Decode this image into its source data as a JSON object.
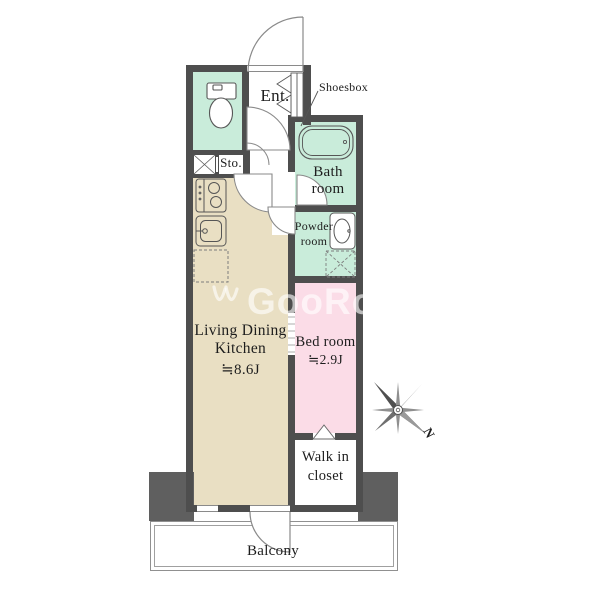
{
  "colors": {
    "wall": "#4e4e4e",
    "pillar": "#5f5f5f",
    "mint": "#c9ecda",
    "beige": "#e9dfc3",
    "pink": "#fbdce7"
  },
  "watermark": {
    "text": "GooRooM",
    "logo_icon": "goodroom-bird-logo"
  },
  "compass": {
    "north_label": "N",
    "icon": "compass-rose-icon"
  },
  "labels": {
    "entrance": "Ent.",
    "shoesbox": "Shoesbox",
    "storage": "Sto.",
    "bath_line1": "Bath",
    "bath_line2": "room",
    "powder_line1": "Powder",
    "powder_line2": "room",
    "ldk_line1": "Living Dining",
    "ldk_line2": "Kitchen",
    "ldk_size": "≒8.6J",
    "bedroom": "Bed room",
    "bedroom_size": "≒2.9J",
    "wic_line1": "Walk in",
    "wic_line2": "closet",
    "balcony": "Balcony"
  },
  "icons": [
    "toilet-icon",
    "bathtub-icon",
    "stove-icon",
    "kitchen-sink-icon",
    "washbasin-icon",
    "washing-machine-space-icon",
    "pipe-space-icon",
    "refrigerator-space-icon",
    "shoesbox-icon",
    "door-swing-arc-icon",
    "sliding-door-icon",
    "compass-rose-icon"
  ]
}
